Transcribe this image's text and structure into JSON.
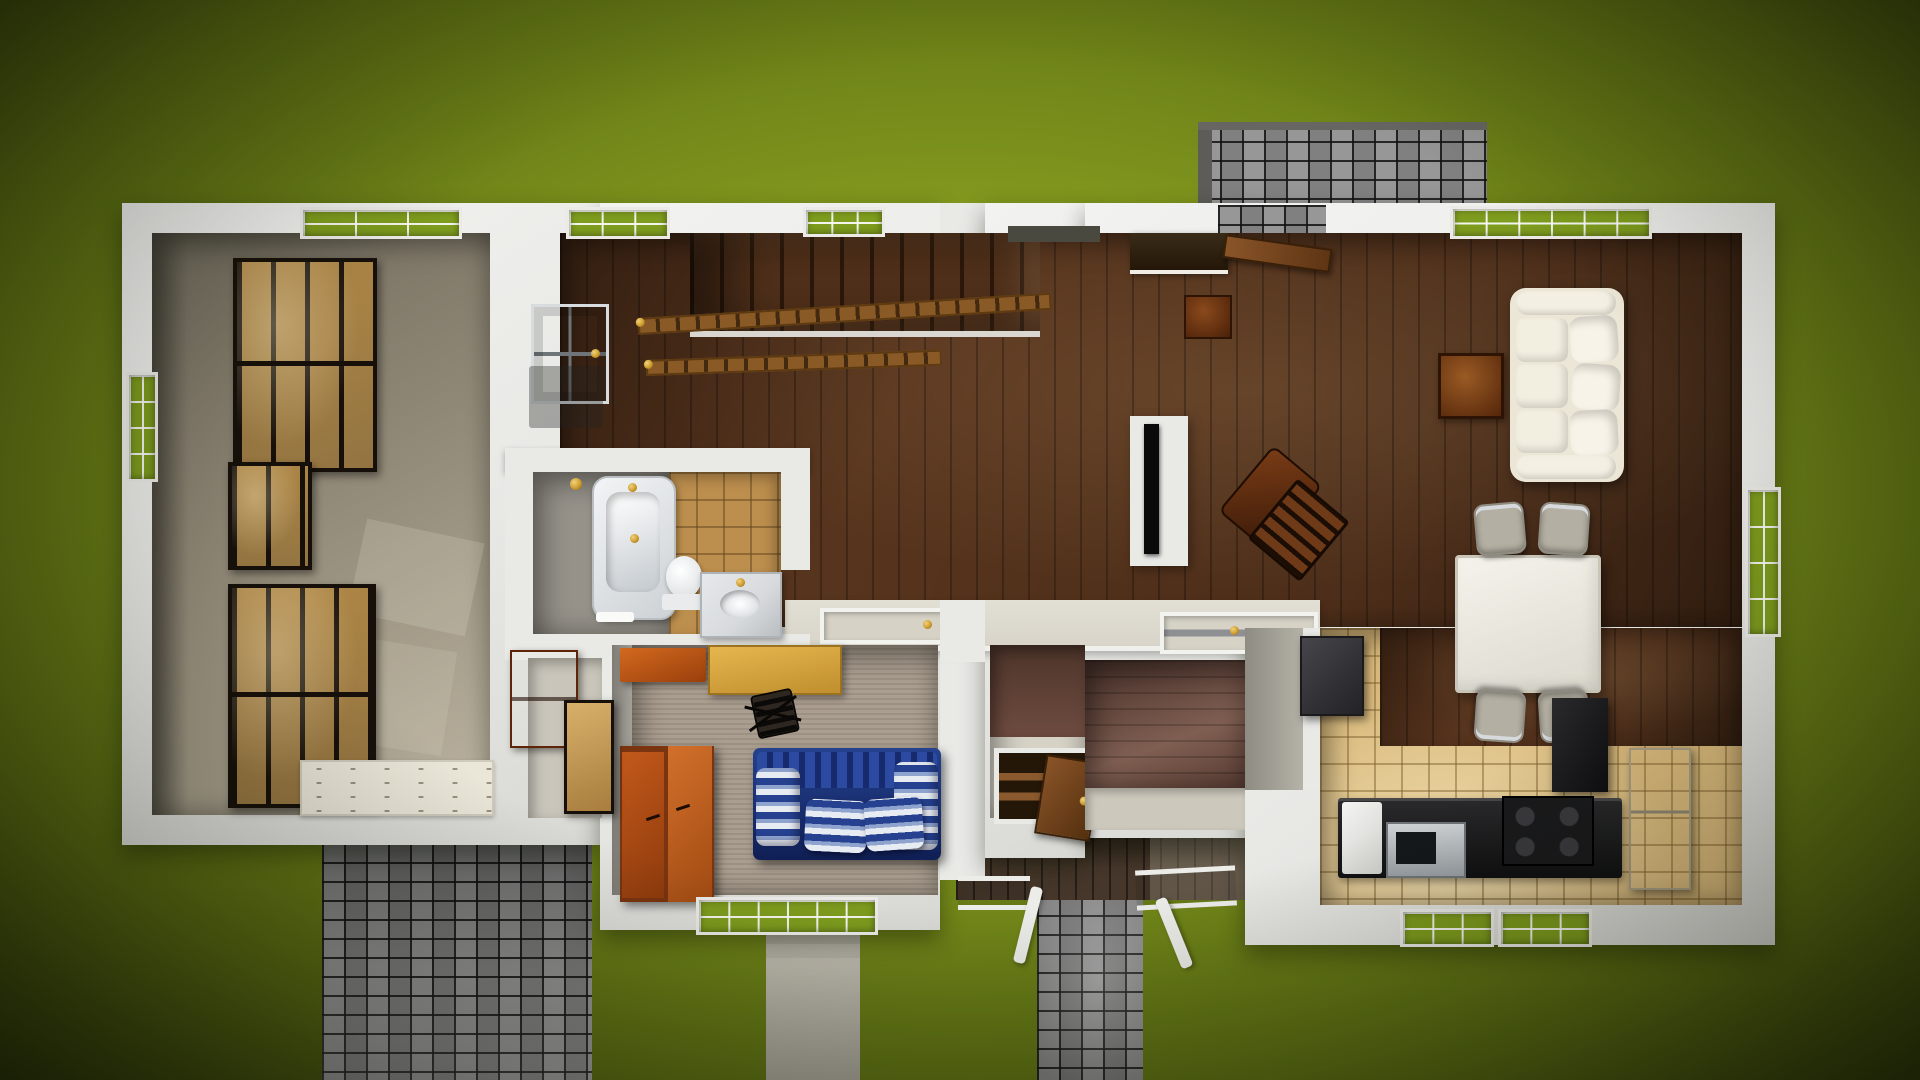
{
  "scene": {
    "title": "Top-down 3D render of a single-story house interior floor plan on a green lawn",
    "environment": {
      "ground": "grass lawn with dark vignette",
      "paving": [
        "rear brick patio (top right)",
        "brick driveway (bottom left)",
        "brick walkway (bottom center)",
        "concrete side steps (below bedroom)",
        "wood deck with white railings"
      ]
    },
    "rooms": [
      {
        "name": "garage-storage",
        "floor": "concrete",
        "items": [
          "storage-rack-1",
          "storage-rack-2",
          "storage-rack-3",
          "garage-door-panel",
          "garage-window-top",
          "garage-window-left",
          "sunlight-patches"
        ]
      },
      {
        "name": "foyer-stair-hall",
        "floor": "dark hardwood",
        "items": [
          "staircase",
          "stair-railing-upper",
          "stair-railing-lower",
          "front-door",
          "door-mat",
          "foyer-window-top",
          "hall-window-top"
        ]
      },
      {
        "name": "living-room",
        "floor": "dark hardwood",
        "items": [
          "tv-partition-with-tv",
          "rocking-chair",
          "patio-door-opening",
          "open-door-leaf",
          "dark-console-cabinet",
          "entry-shadow-strip",
          "side-table-small",
          "side-table-large",
          "white-sofa",
          "living-window-top",
          "right-wall-window"
        ]
      },
      {
        "name": "dining-area",
        "floor": "hardwood",
        "items": [
          "dining-table",
          "dining-chair x4"
        ]
      },
      {
        "name": "kitchen",
        "floor": "tan ceramic tile",
        "items": [
          "charcoal-refrigerator",
          "black-pantry-cabinet",
          "beige-refrigerator",
          "black-counter",
          "dishwasher",
          "microwave",
          "stove-4-burners",
          "kitchen-window-1",
          "kitchen-window-2"
        ]
      },
      {
        "name": "bathroom",
        "floor": "gray + tan tile",
        "items": [
          "bathtub",
          "shower-head",
          "toilet",
          "marble-vanity-sink",
          "towel"
        ]
      },
      {
        "name": "bedroom-office",
        "floor": "beige carpet",
        "items": [
          "overhead-cabinet",
          "desk",
          "office-chair",
          "orange-wardrobe",
          "blue-striped-couch",
          "double-window"
        ]
      },
      {
        "name": "mudroom-hall",
        "floor": "wood + vinyl",
        "items": [
          "pass-through-counter",
          "tray-1",
          "tray-2",
          "basement-hatch",
          "open-hatch-door"
        ]
      },
      {
        "name": "closet-nook",
        "floor": "vinyl",
        "items": [
          "orange-dresser",
          "storage-crate"
        ]
      }
    ]
  },
  "palette": {
    "lawn1": "#90a524",
    "lawn2": "#7f951d",
    "lawn3": "#5d7013",
    "lawn4": "#39460c",
    "wall": "#e9e9e6",
    "concrete": "#a49c89",
    "wood": "#57341d",
    "hallwood": "#6e4b40",
    "tile": "#d9b97b",
    "bathtile": "#bd8f4e",
    "bathgray": "#96928a",
    "carpet": "#a79a8b",
    "brick": "#8f8f8f",
    "deck": "#46372a",
    "bluecouch": "#1c3a8f",
    "orange": "#b5541c",
    "desk": "#d9a43c",
    "sofa": "#ece6d6",
    "crate": "#c49b57",
    "rackframe": "#17100a",
    "marble": "#d7dadc",
    "gold": "#c9972a",
    "windowgreen": "#7e9c1e",
    "counter": "#d8d4c9",
    "charcoal": "#323236",
    "steel": "#b8bcc0"
  }
}
